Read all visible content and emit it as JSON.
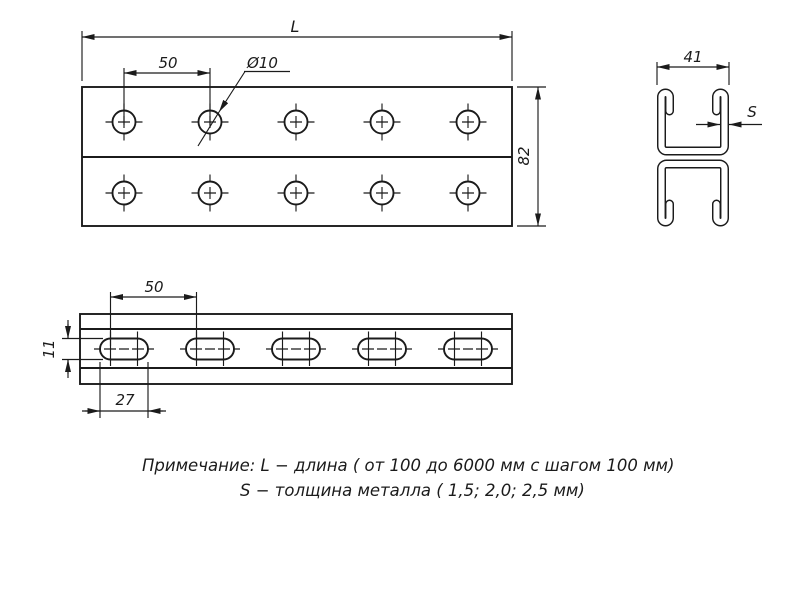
{
  "drawing": {
    "title_note": {
      "line1": "Примечание: L − длина ( от 100 до 6000 мм с шагом 100 мм)",
      "line2": "S − толщина металла ( 1,5; 2,0; 2,5 мм)"
    },
    "dims": {
      "length": "L",
      "hole_pitch": "50",
      "hole_diameter": "Ø10",
      "profile_height": "82",
      "slot_pitch": "50",
      "slot_height": "11",
      "slot_length": "27",
      "section_width": "41",
      "metal_thickness": "S"
    },
    "counts": {
      "top_view_hole_rows": 2,
      "top_view_holes_per_row": 5,
      "side_view_slots": 5
    },
    "colors": {
      "line": "#1b1b1b",
      "background": "#ffffff"
    }
  }
}
